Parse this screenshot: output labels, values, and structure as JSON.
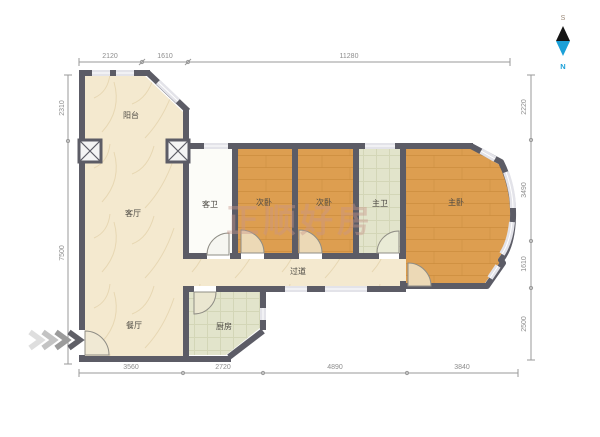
{
  "watermark": "正顺好房",
  "compass": {
    "south": "S",
    "north": "N"
  },
  "rooms": {
    "balcony": "阳台",
    "living": "客厅",
    "guest_bath": "客卫",
    "bedroom_a": "次卧",
    "bedroom_b": "次卧",
    "master_bath": "主卫",
    "master_bedroom": "主卧",
    "hallway": "过道",
    "dining": "餐厅",
    "kitchen": "厨房"
  },
  "dimensions": {
    "top": [
      "2120",
      "1610",
      "11280"
    ],
    "bottom": [
      "3560",
      "2720",
      "4890",
      "3840"
    ],
    "left": [
      "2310",
      "7500"
    ],
    "right": [
      "2220",
      "3490",
      "1610",
      "2500"
    ]
  },
  "colors": {
    "wall": "#5c5c66",
    "wood_floor": "#dd9e50",
    "marble_floor": "#f4e9cf",
    "tile_floor": "#e2e4cb",
    "window": "#e3e3e9",
    "north_accent": "#1ba0d8",
    "dimension_gray": "#8d8d8d"
  }
}
